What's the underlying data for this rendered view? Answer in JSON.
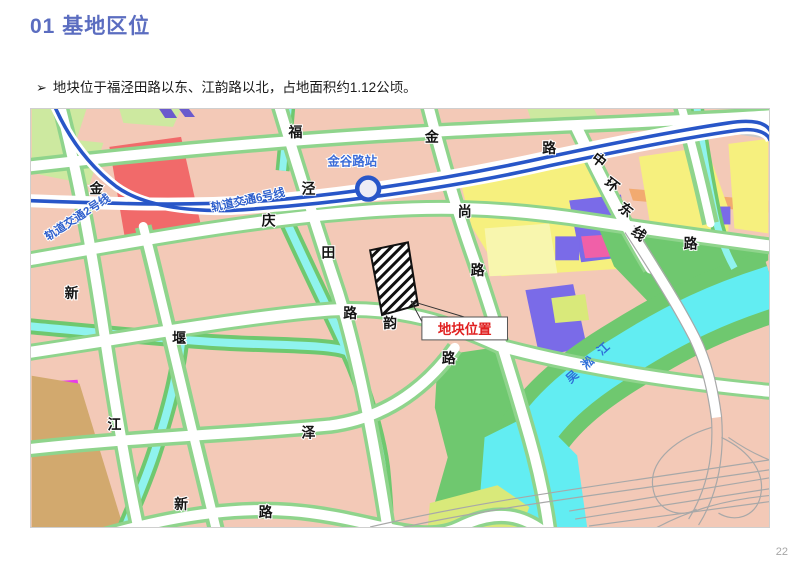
{
  "slide": {
    "title": "01 基地区位",
    "bullet_marker": "➢",
    "bullet": "地块位于福泾田路以东、江韵路以北，占地面积约1.12公顷。",
    "page_number": "22",
    "title_color": "#5B6DC0"
  },
  "map": {
    "station": {
      "label": "金谷路站"
    },
    "site": {
      "label": "地块位置",
      "label_color": "#E02020"
    },
    "river": {
      "label": "吴淞江",
      "label_color": "#2F6FD8"
    },
    "metro_labels": [
      {
        "t": "轨道交通2号线",
        "x": 48,
        "y": 112,
        "r": -33
      },
      {
        "t": "轨道交通6号线",
        "x": 218,
        "y": 95,
        "r": -12
      }
    ],
    "road_labels": [
      {
        "t": "福",
        "x": 265,
        "y": 28
      },
      {
        "t": "金",
        "x": 402,
        "y": 33
      },
      {
        "t": "路",
        "x": 520,
        "y": 44
      },
      {
        "t": "金",
        "x": 65,
        "y": 85
      },
      {
        "t": "泾",
        "x": 278,
        "y": 85
      },
      {
        "t": "田",
        "x": 298,
        "y": 149
      },
      {
        "t": "路",
        "x": 320,
        "y": 210
      },
      {
        "t": "庆",
        "x": 238,
        "y": 117
      },
      {
        "t": "尚",
        "x": 435,
        "y": 108
      },
      {
        "t": "路",
        "x": 448,
        "y": 167
      },
      {
        "t": "路",
        "x": 662,
        "y": 140
      },
      {
        "t": "韵",
        "x": 360,
        "y": 220
      },
      {
        "t": "路",
        "x": 419,
        "y": 255
      },
      {
        "t": "新",
        "x": 40,
        "y": 190
      },
      {
        "t": "堰",
        "x": 148,
        "y": 235
      },
      {
        "t": "江",
        "x": 83,
        "y": 322
      },
      {
        "t": "泽",
        "x": 278,
        "y": 330
      },
      {
        "t": "新",
        "x": 150,
        "y": 402
      },
      {
        "t": "路",
        "x": 235,
        "y": 410
      },
      {
        "t": "中",
        "x": 567,
        "y": 55,
        "r": 38
      },
      {
        "t": "环",
        "x": 580,
        "y": 80,
        "r": 38
      },
      {
        "t": "东",
        "x": 594,
        "y": 105,
        "r": 38
      },
      {
        "t": "线",
        "x": 607,
        "y": 129,
        "r": 38
      }
    ],
    "colors": {
      "metro_line": "#2856C8",
      "water": "#62EDF2",
      "green_bank": "#6FC86F",
      "road_verge": "#8FD48C",
      "block_pink": "#F3C9B7",
      "block_yellow": "#F6F07E",
      "block_purple": "#7A6BE8",
      "block_red": "#F16A6A"
    }
  }
}
